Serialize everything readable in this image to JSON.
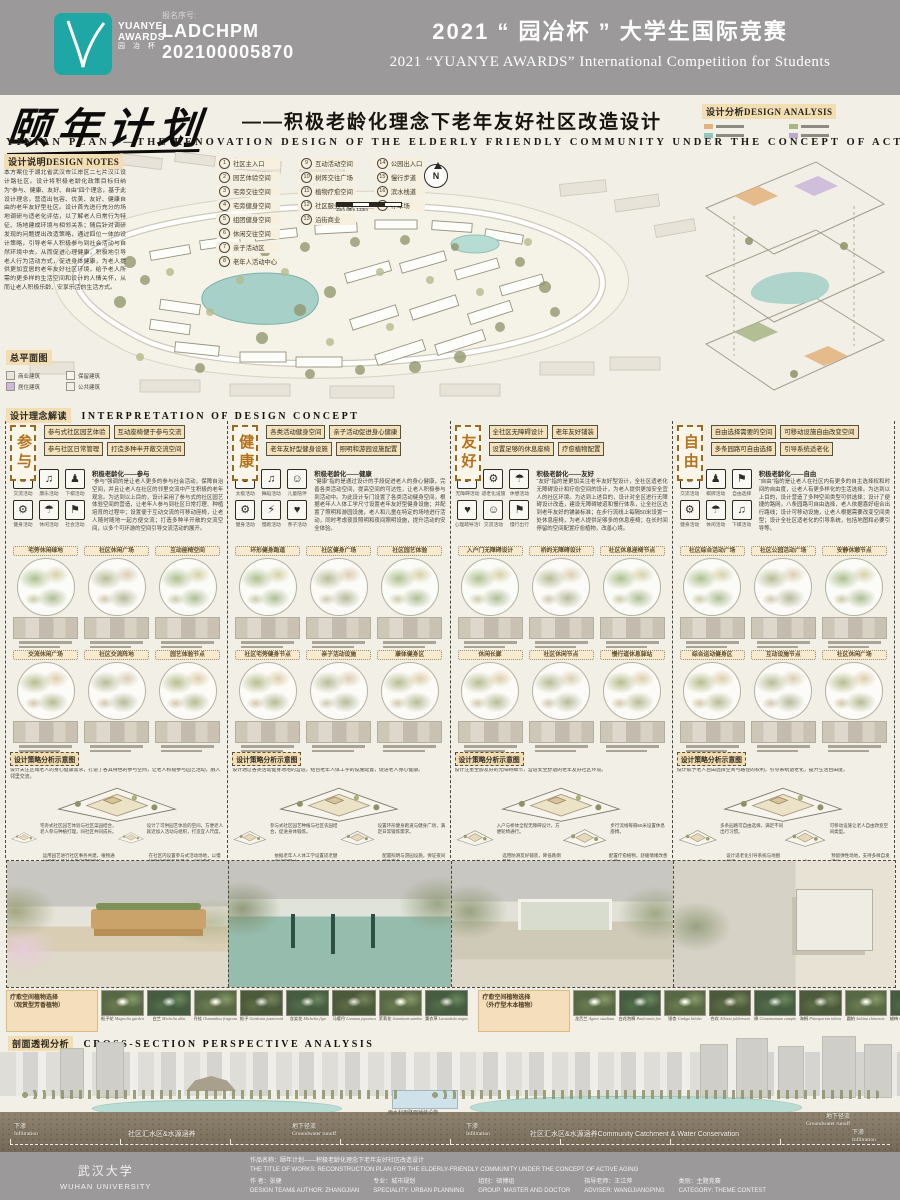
{
  "header": {
    "logo": {
      "line1": "YUANYE",
      "line2": "AWARDS",
      "line3": "园 冶 杯"
    },
    "reg_label": "报名序号:",
    "reg_line1": "LADCHPM",
    "reg_line2": "202100005870",
    "title_cn": "2021 “ 园冶杯 ” 大学生国际竞赛",
    "title_en": "2021 “YUANYE AWARDS” International Competition for  Students"
  },
  "title": {
    "calligraphy": "颐年计划",
    "subtitle_cn": "——积极老龄化理念下老年友好社区改造设计",
    "subtitle_en": "YINIAN  PLAN——THE  RENOVATION  DESIGN  OF  THE  ELDERLY  FRIENDLY  COMMUNITY  UNDER  THE  CONCEPT  OF  ACTIVE  AGING"
  },
  "notes": {
    "label_cn": "设计说明",
    "label_en": "DESIGN NOTES",
    "text": "本方案位于湖北省武汉市江岸区二七片汉江设计路社区。设计将积极老龄化政策目标归纳为“参与、健康、友好、自由”四个理念，基于此设计理念，营造出包容、优美、友好、健康自由的老年友好型社区。设计首先进行充分的场地调研与适老化评估，以了解老人日常行为特征、场地建成环境与相邻关系；随后针对调研发现的问题提出改造策略，通过四位一体的设计策略，引导老年人积极参与到社会活动与自然环境中去，从而促进心理健康，积极地引导老人行为活动方式，促进身体健康，为老人提供更加宜居的老年友好社区环境，给予老人所需的更多样的生活空间和设计的人情关怀，从而让老人积极乐龄、安享乐活的生活方式。"
  },
  "map": {
    "plan_label": "总平面图",
    "north": "N",
    "scale_text": "33m   66m        133m",
    "legend_a": [
      {
        "n": "1",
        "t": "社区主入口"
      },
      {
        "n": "2",
        "t": "园艺体验空间"
      },
      {
        "n": "3",
        "t": "宅旁交往空间"
      },
      {
        "n": "4",
        "t": "宅旁健身空间"
      },
      {
        "n": "5",
        "t": "组团健身空间"
      },
      {
        "n": "6",
        "t": "休闲交往空间"
      },
      {
        "n": "7",
        "t": "亲子活动区"
      },
      {
        "n": "8",
        "t": "老年人活动中心"
      }
    ],
    "legend_b": [
      {
        "n": "9",
        "t": "互动活动空间"
      },
      {
        "n": "10",
        "t": "树阵交往广场"
      },
      {
        "n": "11",
        "t": "植物疗愈空间"
      },
      {
        "n": "12",
        "t": "社区服务中心"
      },
      {
        "n": "13",
        "t": "沿街商业"
      }
    ],
    "legend_c": [
      {
        "n": "14",
        "t": "公园出入口"
      },
      {
        "n": "15",
        "t": "慢行步道"
      },
      {
        "n": "16",
        "t": "滨水栈道"
      },
      {
        "n": "17",
        "t": "停车场"
      }
    ],
    "mini_legend": [
      "商业建筑",
      "保留建筑",
      "居住建筑",
      "公共建筑"
    ]
  },
  "analysis": {
    "label_cn": "设计分析",
    "label_en": "DESIGN  ANALYSIS"
  },
  "concept": {
    "heading_cn": "设计理念解读",
    "heading_en": "INTERPRETATION  OF  DESIGN  CONCEPT",
    "strategy_label": "设计策略分析示意图",
    "columns": [
      {
        "char": "参与",
        "tags": [
          "参与式社区园艺体验",
          "互动座椅便于参与交流",
          "参与社区日常管理",
          "打造多种半开敞交流空间"
        ],
        "icons": [
          {
            "g": "☺",
            "t": "交流活动"
          },
          {
            "g": "♫",
            "t": "康乐活动"
          },
          {
            "g": "♟",
            "t": "下棋活动"
          },
          {
            "g": "⚙",
            "t": "健身活动"
          },
          {
            "g": "☂",
            "t": "休闲活动"
          },
          {
            "g": "⚑",
            "t": "社会活动"
          }
        ],
        "para_title": "积极老龄化——参与",
        "para": "“参与”强调的是让老人更多的参与社会活动，保障自治空间，并且让老人在社区的邻里交流中产生积极的老年观念。为达到以上目的，设计采用了参与式的社区园艺体验空间的营造，让老年人参与到社区日常打理、种植培育的过程中；设置便于互动交流的可移动座椅，让老人随时随地一起方便交流；打造多种半开敞的交流空间，以多个可环游的空间引导交流活动的展开。",
        "circles": [
          "宅旁休闲绿地",
          "社区休闲广场",
          "互动座椅空间",
          "交流休闲广场",
          "社区交流阵地",
          "园艺体验节点"
        ],
        "intro": "设计关注区域老人的身心健康需求，打造了各具特色的参与空间，让老人积极参与园艺活动，融入邻里交流。",
        "strategy": [
          "宅旁式社区园艺体验与社区菜园结合，老人参与种植打理，同社区共同成长。",
          "设计了可供园艺体验的空间，方便老人就近加入活动与组织，打造宜人尺度。",
          "运用园艺进行社区事务共建，植物通过老年人的社会参与得到养护。",
          "在社区内设置参与式活动场地，以慢行系统串联各处节点，引导参与。"
        ]
      },
      {
        "char": "健康",
        "tags": [
          "各类活动健身空间",
          "亲子活动促进身心健康",
          "老年友好型健身设施",
          "照明和游园设施配置"
        ],
        "icons": [
          {
            "g": "☯",
            "t": "太极活动"
          },
          {
            "g": "♫",
            "t": "舞蹈活动"
          },
          {
            "g": "☺",
            "t": "儿童陪伴"
          },
          {
            "g": "⚙",
            "t": "健身活动"
          },
          {
            "g": "⚡",
            "t": "慢跑活动"
          },
          {
            "g": "♥",
            "t": "亲子活动"
          }
        ],
        "para_title": "积极老龄化——健康",
        "para": "“健康”指的是通过设计的手段促进老人的身心健康，完善各类活动空间，提高空间的可达性，让老人积极参与到活动中。为此设计专门设置了各类活动健身空间，根据老年人人体工学尺寸设置老年友好型健身设施；并配置了照明和游园设施，老人和儿童在特定的场地进行活动，同时考虑夜景照明和夜间照明设施，提升活动的安全体验。",
        "circles": [
          "环形健身跑道",
          "社区健身广场",
          "社区园艺体验",
          "社区宅旁健身节点",
          "亲子活动设施",
          "康体健身区"
        ],
        "intro": "设计通过各类活动健身场地的营造，结合老年人体工学的设施配置，促进老人身心健康。",
        "strategy": [
          "参与式社区园艺种植与社区农园结合，促进身体锻炼。",
          "设置环形健身跑道与健身广场，满足日常锻炼需求。",
          "依据老年人人体工学设置适老健身设施尺寸。",
          "配置照明与游园设施，保证夜间活动安全。"
        ]
      },
      {
        "char": "友好",
        "tags": [
          "全社区无障碍设计",
          "老年友好铺装",
          "设置足够的休息座椅",
          "疗愈植物配置"
        ],
        "icons": [
          {
            "g": "♿",
            "t": "无障碍活动"
          },
          {
            "g": "⚙",
            "t": "适老化设施"
          },
          {
            "g": "☂",
            "t": "休憩活动"
          },
          {
            "g": "♥",
            "t": "心理疏导活动"
          },
          {
            "g": "☺",
            "t": "交流活动"
          },
          {
            "g": "⚑",
            "t": "慢行出行"
          }
        ],
        "para_title": "积极老龄化——友好",
        "para": "“友好”指的是更加关注老年友好型设计，全社区适老化无障碍设计和疗愈空间的设计，为老人提供更加安全宜人的社区环境。为达到上述目的，设计对全区进行无障碍设计改造，建设无障碍坡道和慢行体系，让全社区达到老年友好的铺装标准；在步行流线上每隔50米设置一处休息座椅，为老人提供足够多的休息座椅；在长时间停留的空间配置疗愈植物，改善心境。",
        "circles": [
          "入户门无障碍设计",
          "桥的无障碍设计",
          "社区休息座椅节点",
          "休闲长廊",
          "社区休闲节点",
          "慢行道休息驿站"
        ],
        "intro": "设计注重全龄友好的无障碍细节，营造安全舒适的老年友好社区环境。",
        "strategy": [
          "入户与桥体全程无障碍设计，方便轮椅通行。",
          "步行流线每隔50米设置休息座椅。",
          "选用防滑友好铺装，降低跌倒风险。",
          "配置疗愈植物，舒缓情绪改善心境。"
        ]
      },
      {
        "char": "自由",
        "tags": [
          "自由选择需要的空间",
          "可移动设施自由改变空间",
          "多条园路可自由选择",
          "引导系统适老化"
        ],
        "icons": [
          {
            "g": "☺",
            "t": "交流活动"
          },
          {
            "g": "♟",
            "t": "棋牌活动"
          },
          {
            "g": "⚑",
            "t": "自由选择"
          },
          {
            "g": "⚙",
            "t": "健身活动"
          },
          {
            "g": "☂",
            "t": "休闲活动"
          },
          {
            "g": "♫",
            "t": "下棋活动"
          }
        ],
        "para_title": "积极老龄化——自由",
        "para": "“自由”指的是让老人在社区内有更多的自主选择权和时间的自由度，让老人有更多样化的生活选择。为达到以上目的，设计营造了多种空间类型可供选择；设计了便捷的路网，八条园路可自由选择，老人依据喜好组合出行路线；设计可移动设施，让老人根据需要改变空间类型；设计全社区适老化的引导系统，包括地图和必要引导等。",
        "circles": [
          "社区综合活动广场",
          "社区公园活动广场",
          "安静休憩节点",
          "综合运动健身区",
          "互动设施节点",
          "社区休闲广场"
        ],
        "intro": "设计赋予老人自由选择空间与路径的权利，引导系统适老化，提升生活自由度。",
        "strategy": [
          "多条园路可自由选择，满足不同出行习惯。",
          "可移动设施让老人自由改变空间类型。",
          "设计适老化引导系统与地图标识。",
          "预留弹性场地，支持多样自发活动。"
        ]
      }
    ]
  },
  "plants": {
    "left": {
      "l1": "疗愈空间植物选择",
      "l2": "（观赏型芳香植物）",
      "items": [
        {
          "cn": "栀子花",
          "en": "Magnolia gardenia"
        },
        {
          "cn": "白兰",
          "en": "Michelia alba"
        },
        {
          "cn": "丹桂",
          "en": "Osmanthus fragrans"
        },
        {
          "cn": "栀子",
          "en": "Gardenia jasminoides"
        },
        {
          "cn": "含笑花",
          "en": "Michelia figo"
        },
        {
          "cn": "马缨丹",
          "en": "Lantana japonica"
        },
        {
          "cn": "茉莉花",
          "en": "Jasminum sambac"
        },
        {
          "cn": "薰衣草",
          "en": "Lavandula angustifolia"
        }
      ]
    },
    "right": {
      "l1": "疗愈空间植物选择",
      "l2": "（外疗型木本植物）",
      "items": [
        {
          "cn": "龙舌兰",
          "en": "Agave sisalana"
        },
        {
          "cn": "白花泡桐",
          "en": "Paulownia fortunei"
        },
        {
          "cn": "银杏",
          "en": "Ginkgo biloba"
        },
        {
          "cn": "合欢",
          "en": "Albizia julibrissin"
        },
        {
          "cn": "樟",
          "en": "Cinnamomum camphora"
        },
        {
          "cn": "海桐",
          "en": "Pittosporum tobira"
        },
        {
          "cn": "圆柏",
          "en": "Sabina chinensis"
        },
        {
          "cn": "蜡梅",
          "en": "Chimonanthus praecox"
        }
      ]
    }
  },
  "xsec": {
    "heading_cn": "剖面透视分析",
    "heading_en": "CROSS-SECTION  PERSPECTIVE  ANALYSIS",
    "s1cn": "下渗",
    "s1en": "Infiltration",
    "s2": "社区汇水区&水源涵养",
    "s3cn": "地下径流",
    "s3en": "Groundwater runoff",
    "s4cn": "下渗",
    "s4en": "Infiltration",
    "s5": "雨水利用路面铺装设施",
    "s6": "社区汇水区&水源涵养Community Catchment & Water Conservation",
    "s7cn": "地下径流",
    "s7en": "Groundwater runoff",
    "s8cn": "下渗",
    "s8en": "Infiltration"
  },
  "footer": {
    "university_cn": "武汉大学",
    "university_en": "WUHAN UNIVERSITY",
    "work_title_cn": "作品名称：颐年计划——积极老龄化理念下老年友好社区改造设计",
    "work_title_en": "THE TITLE OF WORKS: RECONSTRUCTION PLAN FOR THE ELDERLY-FRIENDLY COMMUNITY UNDER THE CONCEPT OF ACTIVE AGING",
    "author_cn": "作    者：张健",
    "author_en": "DESIGN TEAM& AUTHOR: ZHANGJIAN",
    "speciality_cn": "专业：城市规划",
    "speciality_en": "SPECIALITY: URBAN PLANNING",
    "group_cn": "组别：硕博组",
    "group_en": "GROUP: MASTER AND DOCTOR",
    "adviser_cn": "指导老师：王江萍",
    "adviser_en": "ADVISER: WANGJIANGPING",
    "category_cn": "类别：主题竞赛",
    "category_en": "CATEGORY: THEME CONTEST"
  }
}
